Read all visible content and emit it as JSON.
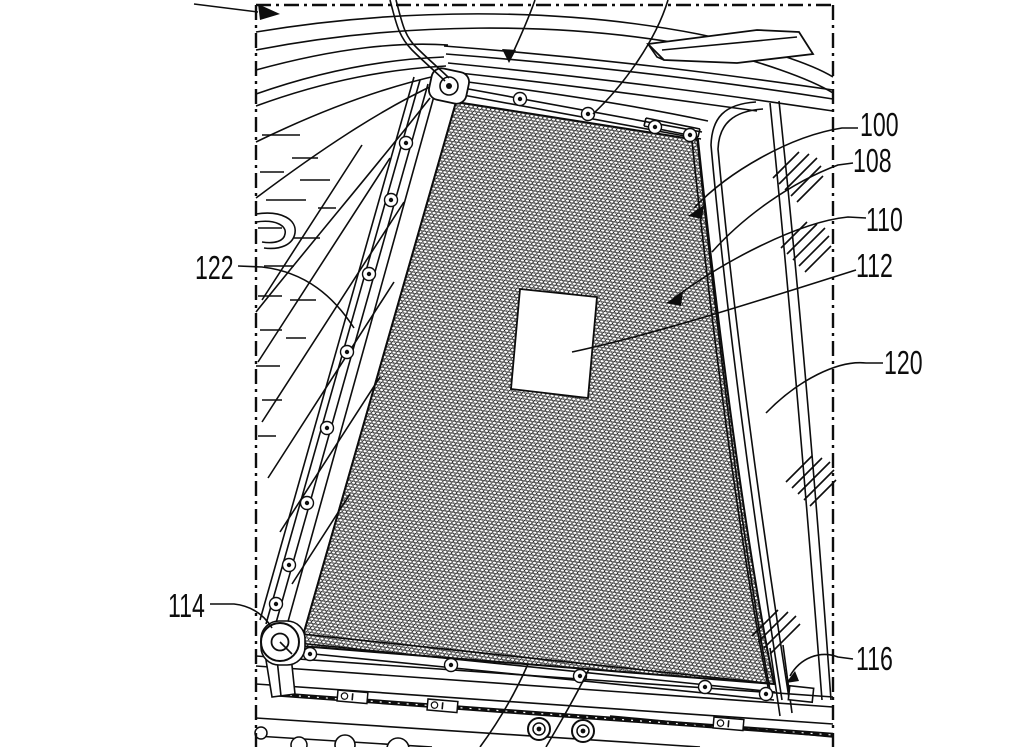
{
  "figure": {
    "kind": "patent-line-drawing",
    "colors": {
      "ink": "#0d0d0d",
      "background": "#ffffff"
    },
    "reference_labels": [
      {
        "number": "100"
      },
      {
        "number": "108"
      },
      {
        "number": "110"
      },
      {
        "number": "112"
      },
      {
        "number": "120"
      },
      {
        "number": "116"
      },
      {
        "number": "122"
      },
      {
        "number": "114"
      }
    ]
  }
}
